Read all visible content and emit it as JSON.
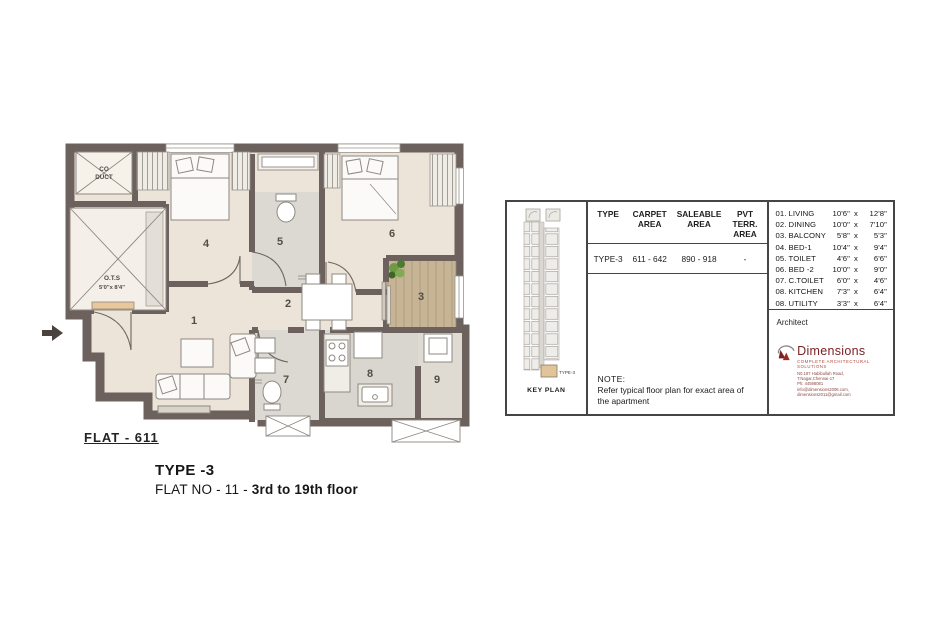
{
  "plan": {
    "flat_label": "FLAT - 611",
    "duct_line1": "CO",
    "duct_line2": "DUCT",
    "ots_line1": "O.T.S",
    "ots_line2": "5'0\"x 8'4\"",
    "rooms": {
      "living": "1",
      "dining": "2",
      "balcony": "3",
      "bed1": "4",
      "toilet": "5",
      "bed2": "6",
      "ctoilet": "7",
      "kitchen": "8",
      "utility": "9"
    },
    "colors": {
      "wall": "#6c615d",
      "floor": "#ece4d8",
      "toilet_floor": "#dcd9d3",
      "balcony_floor": "#c6b495",
      "accent_red": "#7b2125"
    }
  },
  "title": {
    "type": "TYPE -3",
    "flat_prefix": "FLAT NO - 11 - ",
    "flat_bold": "3rd to 19th floor"
  },
  "panel": {
    "key_plan": {
      "label": "KEY PLAN",
      "unit_tag": "TYPE-3"
    },
    "area_table": {
      "headers": [
        {
          "l1": "TYPE",
          "l2": ""
        },
        {
          "l1": "CARPET",
          "l2": "AREA"
        },
        {
          "l1": "SALEABLE",
          "l2": "AREA"
        },
        {
          "l1": "PVT TERR.",
          "l2": "AREA"
        }
      ],
      "row": {
        "type": "TYPE-3",
        "carpet": "611 - 642",
        "saleable": "890 - 918",
        "pvt": "-"
      }
    },
    "note": {
      "heading": "NOTE:",
      "body": "Refer typical floor plan for exact area of the apartment"
    },
    "x_sep": "x",
    "rooms": [
      {
        "no": "01.",
        "name": "LIVING",
        "w": "10'6\"",
        "h": "12'8\""
      },
      {
        "no": "02.",
        "name": "DINING",
        "w": "10'0\"",
        "h": "7'10\""
      },
      {
        "no": "03.",
        "name": "BALCONY",
        "w": "5'8\"",
        "h": "5'3\""
      },
      {
        "no": "04.",
        "name": "BED-1",
        "w": "10'4\"",
        "h": "9'4\""
      },
      {
        "no": "05.",
        "name": "TOILET",
        "w": "4'6\"",
        "h": "6'6\""
      },
      {
        "no": "06.",
        "name": "BED -2",
        "w": "10'0\"",
        "h": "9'0\""
      },
      {
        "no": "07.",
        "name": "C.TOILET",
        "w": "6'0\"",
        "h": "4'6\""
      },
      {
        "no": "08.",
        "name": "KITCHEN",
        "w": "7'3\"",
        "h": "6'4\""
      },
      {
        "no": "08.",
        "name": "UTILITY",
        "w": "3'3\"",
        "h": "6'4\""
      }
    ],
    "architect": {
      "label": "Architect",
      "firm": "Dimensions",
      "tagline": "COMPLETE ARCHITECTURAL SOLUTIONS",
      "address1": "N0.187 Habibullah Road,",
      "address2": "T.Nagar,Chennai-17",
      "phone": "Ph: 44598081",
      "email": "info@dimensions2006.com, dimensions2011@gmail.com"
    }
  }
}
